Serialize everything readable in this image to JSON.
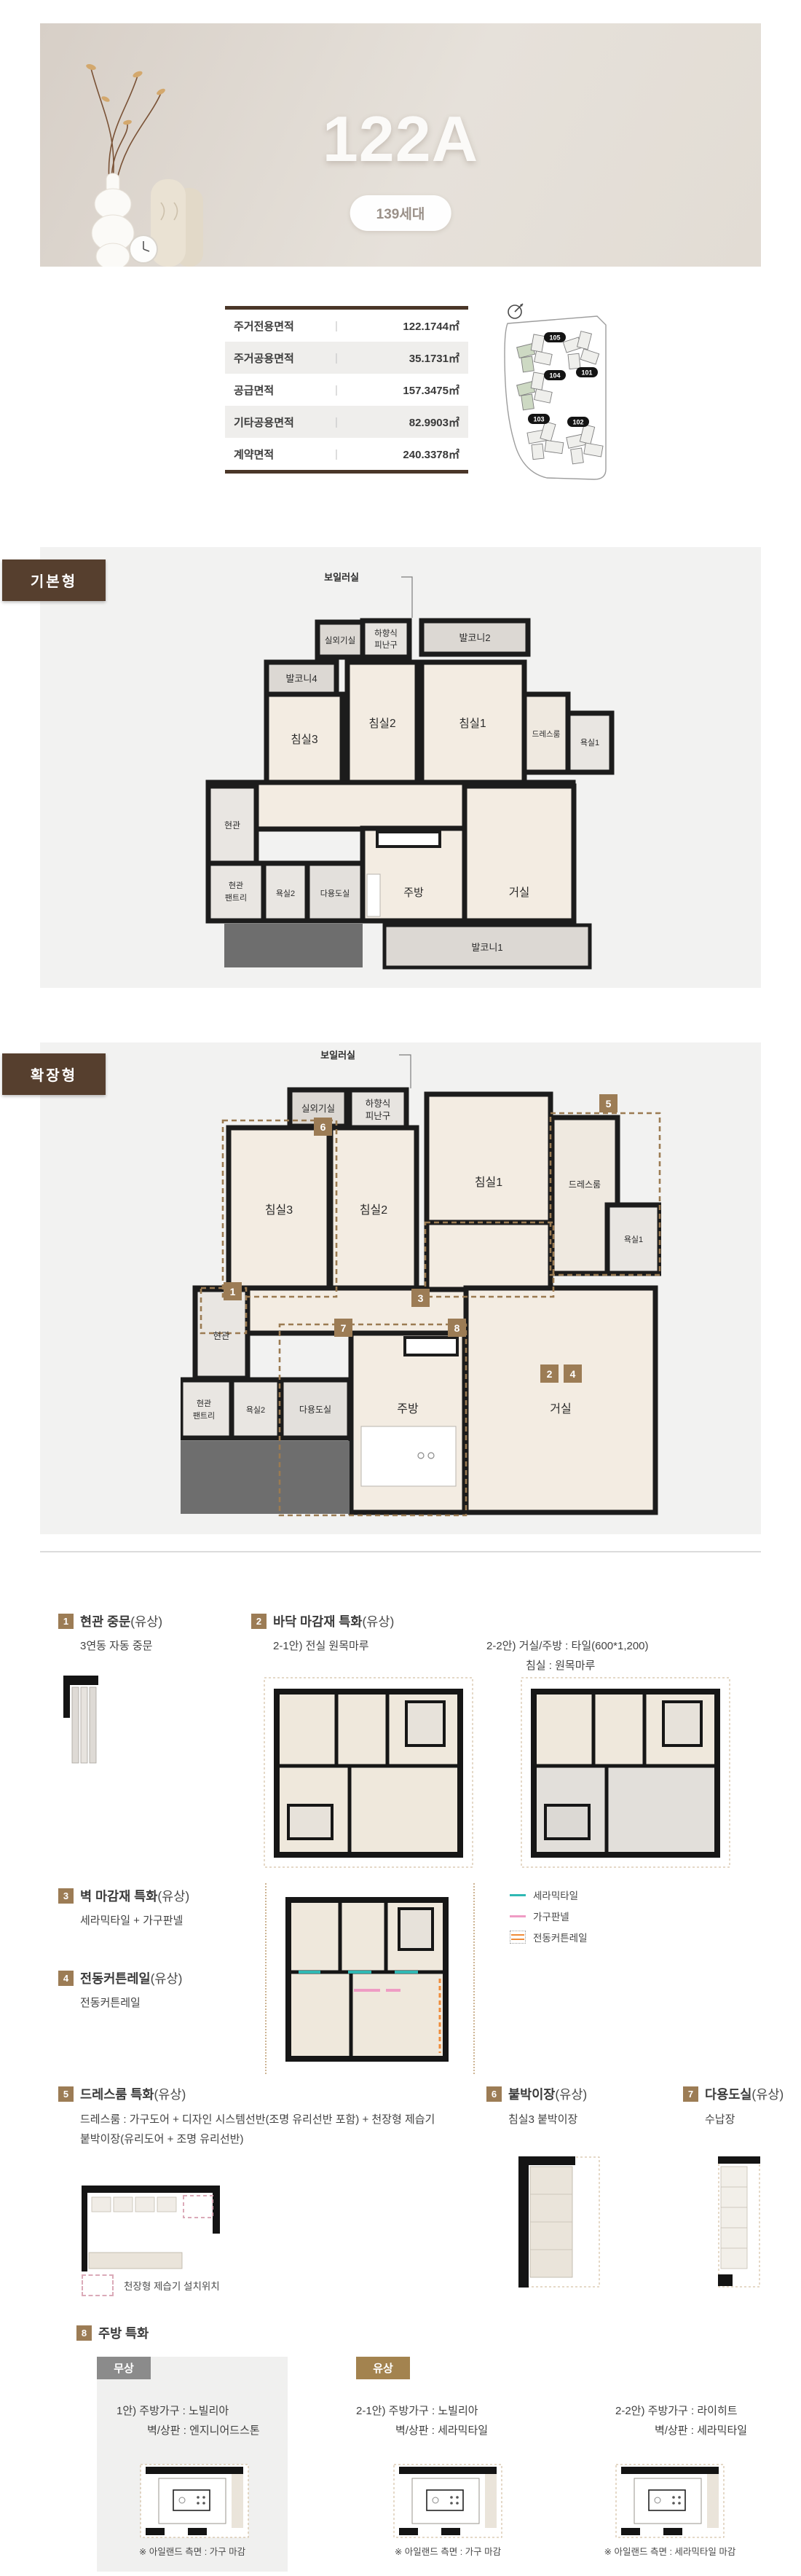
{
  "hero": {
    "title": "122A",
    "badge": "139세대"
  },
  "area_table": {
    "rows": [
      {
        "label": "주거전용면적",
        "value": "122.1744㎡"
      },
      {
        "label": "주거공용면적",
        "value": "35.1731㎡"
      },
      {
        "label": "공급면적",
        "value": "157.3475㎡"
      },
      {
        "label": "기타공용면적",
        "value": "82.9903㎡"
      },
      {
        "label": "계약면적",
        "value": "240.3378㎡"
      }
    ]
  },
  "site_plan": {
    "labels": [
      "105",
      "101",
      "104",
      "103",
      "102"
    ]
  },
  "plan_basic": {
    "badge": "기본형",
    "rooms": {
      "boiler": "보일러실",
      "outdoor_unit": "실외기실",
      "escape1": "하향식",
      "escape2": "피난구",
      "balcony2": "발코니2",
      "balcony4": "발코니4",
      "bed1": "침실1",
      "bed2": "침실2",
      "bed3": "침실3",
      "dress": "드레스룸",
      "bath1": "욕실1",
      "entry": "현관",
      "pantry1": "현관",
      "pantry2": "팬트리",
      "bath2": "욕실2",
      "utility": "다용도실",
      "kitchen": "주방",
      "living": "거실",
      "balcony1": "발코니1"
    }
  },
  "plan_ext": {
    "badge": "확장형",
    "rooms": {
      "boiler": "보일러실",
      "outdoor_unit": "실외기실",
      "escape1": "하향식",
      "escape2": "피난구",
      "bed1": "침실1",
      "bed2": "침실2",
      "bed3": "침실3",
      "dress": "드레스룸",
      "bath1": "욕실1",
      "entry": "현관",
      "pantry1": "현관",
      "pantry2": "팬트리",
      "bath2": "욕실2",
      "utility": "다용도실",
      "kitchen": "주방",
      "living": "거실"
    },
    "markers": [
      "1",
      "2",
      "3",
      "4",
      "5",
      "6",
      "7",
      "8"
    ]
  },
  "features": {
    "f1": {
      "num": "1",
      "title": "현관 중문",
      "paid": "(유상)",
      "desc": "3연동 자동 중문"
    },
    "f2": {
      "num": "2",
      "title": "바닥 마감재 특화",
      "paid": "(유상)",
      "desc1": "2-1안) 전실 원목마루",
      "desc2a": "2-2안) 거실/주방 : 타일(600*1,200)",
      "desc2b": "침실 : 원목마루"
    },
    "f3": {
      "num": "3",
      "title": "벽 마감재 특화",
      "paid": "(유상)",
      "desc": "세라믹타일 + 가구판넬"
    },
    "f4": {
      "num": "4",
      "title": "전동커튼레일",
      "paid": "(유상)",
      "desc": "전동커튼레일"
    },
    "legend": [
      {
        "label": "세라믹타일"
      },
      {
        "label": "가구판넬"
      },
      {
        "label": "전동커튼레일"
      }
    ],
    "f5": {
      "num": "5",
      "title": "드레스룸 특화",
      "paid": "(유상)",
      "desc1": "드레스룸 : 가구도어 + 디자인 시스템선반(조명 유리선반 포함) + 천장형 제습기",
      "desc2": "붙박이장(유리도어 + 조명 유리선반)",
      "note": "천장형 제습기 설치위치"
    },
    "f6": {
      "num": "6",
      "title": "붙박이장",
      "paid": "(유상)",
      "desc": "침실3 붙박이장"
    },
    "f7": {
      "num": "7",
      "title": "다용도실",
      "paid": "(유상)",
      "desc": "수납장"
    },
    "f8": {
      "num": "8",
      "title": "주방 특화",
      "free_tag": "무상",
      "paid_tag": "유상",
      "opt1a": "1안) 주방가구 : 노빌리아",
      "opt1b": "벽/상판 : 엔지니어드스톤",
      "cap1": "※ 아일랜드 측면 : 가구 마감",
      "opt21a": "2-1안) 주방가구 : 노빌리아",
      "opt21b": "벽/상판 : 세라믹타일",
      "cap2": "※ 아일랜드 측면 : 가구 마감",
      "opt22a": "2-2안) 주방가구 : 라이히트",
      "opt22b": "벽/상판 : 세라믹타일",
      "cap3": "※ 아일랜드 측면 : 세라믹타일 마감"
    }
  }
}
